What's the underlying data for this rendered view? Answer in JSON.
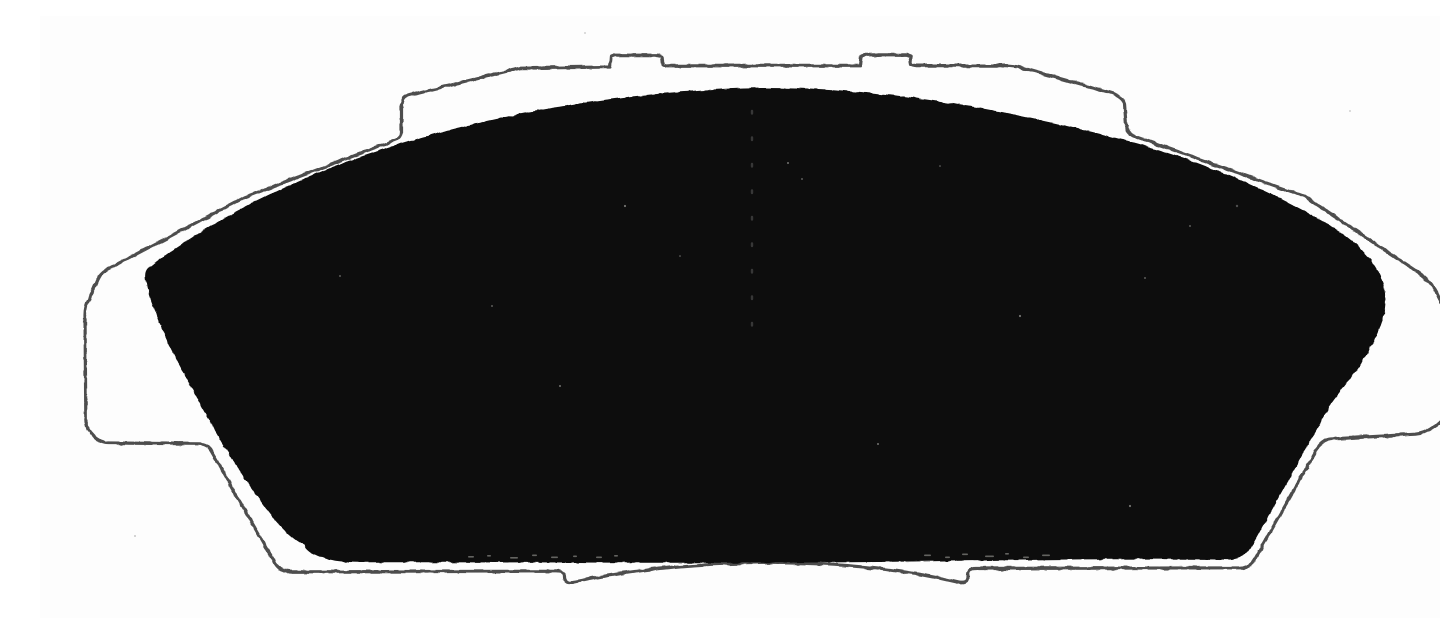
{
  "scan": {
    "subject": "disc-brake-pad",
    "colors": {
      "background": "#fdfdfd",
      "plate_fill": "#fdfdfd",
      "plate_outline": "#4e4e4e",
      "friction_material": "#070707",
      "speckle_light": "#d9d9d4",
      "speckle_dark": "#8f8f8f",
      "groove_dot": "#5a5a5a"
    }
  }
}
